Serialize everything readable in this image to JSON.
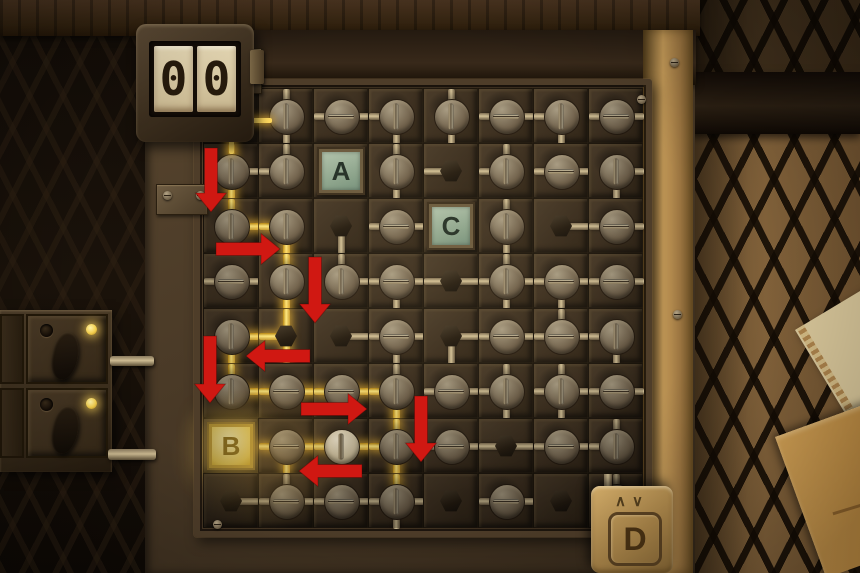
{
  "scene": {
    "description": "circuit dial puzzle board"
  },
  "counter": {
    "digits": [
      "0",
      "0"
    ]
  },
  "tiles": {
    "a": "A",
    "b": "B",
    "c": "C",
    "d": "D",
    "d_carets": "∧∨"
  },
  "grid": {
    "cols": 8,
    "rows": 8,
    "cell_px": 55,
    "origin_x": 203,
    "origin_y": 88,
    "legend": "cell = type:rods:litrods | d=dial h=hex-post w=white-dial A/B/C=letter-tile x=hidden | rods subset of NSEW",
    "cells": [
      [
        "x",
        "d:NS:",
        "d:EW:",
        "d:WS:",
        "d:NS:",
        "d:EW:",
        "d:WS:",
        "d:EW:"
      ],
      [
        "d:NES:NS",
        "d:NW:",
        "A",
        "d:NS:",
        "h:W:",
        "d:NW:",
        "d:WE:",
        "d:ES:"
      ],
      [
        "d:NE:NE",
        "d:WS:WS",
        "h:S:",
        "d:WE:",
        "C",
        "d:NS:",
        "h:E:",
        "d:WE:"
      ],
      [
        "d:WE:",
        "d:NS:NS",
        "d:NE:",
        "d:WES:",
        "h:WE:",
        "d:NSWE:",
        "d:WES:",
        "d:WE:"
      ],
      [
        "d:ES:ES",
        "h:NWS:NWS",
        "h:E:",
        "d:WES:",
        "h:ES:",
        "d:WE:",
        "d:NWE:",
        "d:WS:"
      ],
      [
        "d:NE:NE",
        "d:WE:WE",
        "d:WE:WE",
        "d:NWS:WS",
        "d:WE:",
        "d:NSW:",
        "d:NSWE:",
        "d:WE:"
      ],
      [
        "B",
        "d:WES:WES",
        "w:WE:WE",
        "d:NWS:NWS",
        "d:WE:",
        "h:WE:",
        "d:WE:",
        "d:NW:"
      ],
      [
        "h:E:",
        "d:NWE:",
        "d:WE:",
        "d:NSWE:N",
        "h::",
        "d:WE:",
        "h::",
        "d:NS:"
      ]
    ]
  },
  "wires": {
    "extra": [
      {
        "x": 229,
        "y": 122,
        "w": 5,
        "h": 32
      },
      {
        "x": 246,
        "y": 118,
        "w": 26,
        "h": 5
      }
    ]
  },
  "arrows": [
    {
      "dir": "down",
      "x": 211,
      "y": 148,
      "len": 64
    },
    {
      "dir": "right",
      "x": 216,
      "y": 249,
      "len": 64
    },
    {
      "dir": "down",
      "x": 315,
      "y": 257,
      "len": 66
    },
    {
      "dir": "down",
      "x": 210,
      "y": 336,
      "len": 67
    },
    {
      "dir": "left",
      "x": 246,
      "y": 356,
      "len": 64
    },
    {
      "dir": "right",
      "x": 301,
      "y": 409,
      "len": 66
    },
    {
      "dir": "down",
      "x": 421,
      "y": 396,
      "len": 66
    },
    {
      "dir": "left",
      "x": 299,
      "y": 471,
      "len": 63
    }
  ],
  "panel": {
    "rows": [
      {
        "led_on": true
      },
      {
        "led_on": true
      }
    ]
  },
  "screws": [
    [
      213,
      95
    ],
    [
      637,
      95
    ],
    [
      213,
      520
    ],
    [
      637,
      520
    ],
    [
      670,
      58
    ],
    [
      673,
      310
    ],
    [
      163,
      191
    ],
    [
      196,
      191
    ]
  ],
  "colors": {
    "lit_wire": "#ffd95e",
    "arrow": "#d01812",
    "teal_tile": "#9db39c",
    "b_glow": "#f3d45a",
    "brass": "#c49a58",
    "led": "#f4cf4e"
  }
}
